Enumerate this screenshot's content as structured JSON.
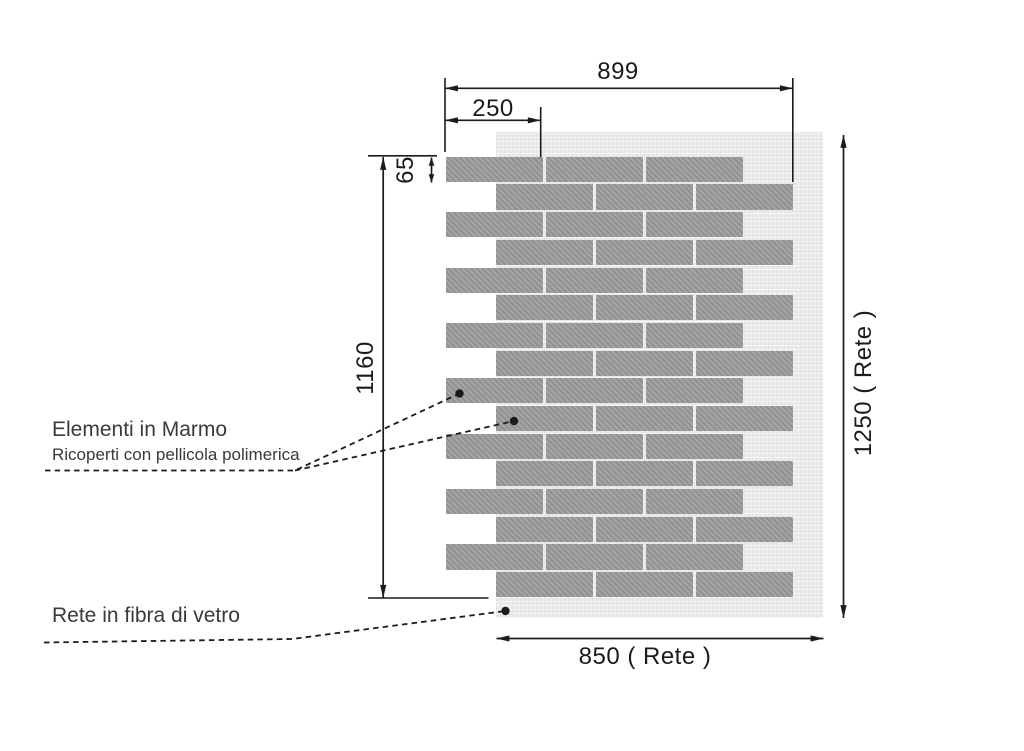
{
  "diagram": {
    "dimensions": {
      "overall_width": "899",
      "element_width": "250",
      "element_height": "65",
      "wall_height": "1160",
      "mesh_height": "1250 ( Rete )",
      "mesh_width": "850 ( Rete )"
    },
    "callouts": {
      "marble_title": "Elementi in Marmo",
      "marble_subtitle": "Ricoperti con pellicola polimerica",
      "mesh_label": "Rete in fibra di vetro"
    },
    "wall": {
      "rows": 16,
      "bricks_per_row": 3,
      "pattern": "running-bond",
      "colors": {
        "brick": "#9c9c9c",
        "mesh": "#eaeaea",
        "line": "#1b1b1b",
        "text": "#3a3a3a"
      }
    }
  }
}
